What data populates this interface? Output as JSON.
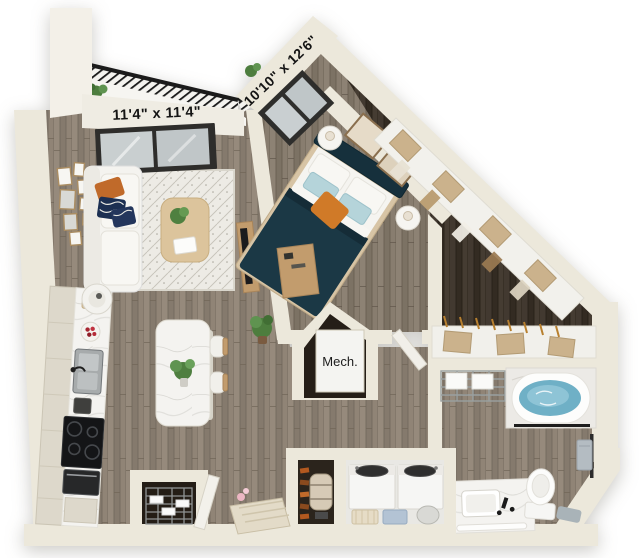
{
  "floorplan": {
    "labels": {
      "living_balcony_dimension": "11'4\" x 11'4\"",
      "bedroom_dimension": "10'10\" x 12'6\"",
      "mech_room": "Mech."
    },
    "colors": {
      "wall": "#ece8db",
      "wall_shade": "#dcd6c6",
      "floor_light_base": "#8d8174",
      "floor_bedroom_base": "#857a6c",
      "floor_closet_base": "#3a3127",
      "bed_teal": "#1b3845",
      "accent_orange": "#d07a28",
      "water_blue": "#6fb0c6",
      "box_tan": "#cbb28c",
      "wood_furniture": "#c29c6d",
      "railing_black": "#1b1b1b",
      "marble_white": "#f4f3f0",
      "rug_cream": "#edebe5"
    }
  }
}
